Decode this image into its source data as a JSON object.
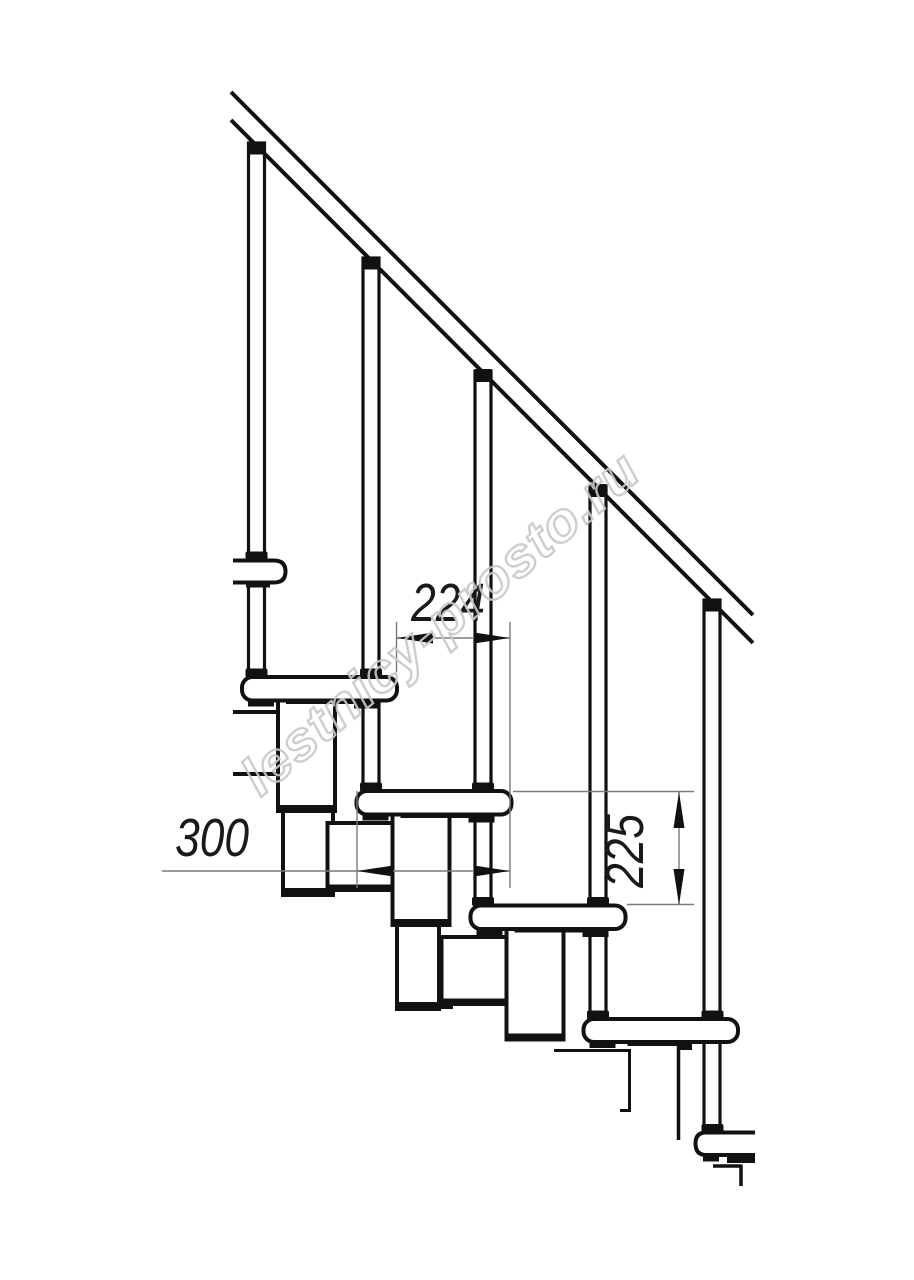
{
  "title": "Modular staircase side-view fragment drawing",
  "watermark": {
    "text": "lestnicy-prosto.ru"
  },
  "dimensions": {
    "run": {
      "value": "224",
      "meaning": "horizontal step run between tread edges"
    },
    "depth": {
      "value": "300",
      "meaning": "tread depth"
    },
    "rise": {
      "value": "225",
      "meaning": "step rise between tread surfaces"
    }
  },
  "colors": {
    "line": "#111111",
    "dim_line": "#7a7a7a",
    "dim_text": "#1a1a1a",
    "watermark": "#c8c8c8",
    "background": "#ffffff"
  }
}
